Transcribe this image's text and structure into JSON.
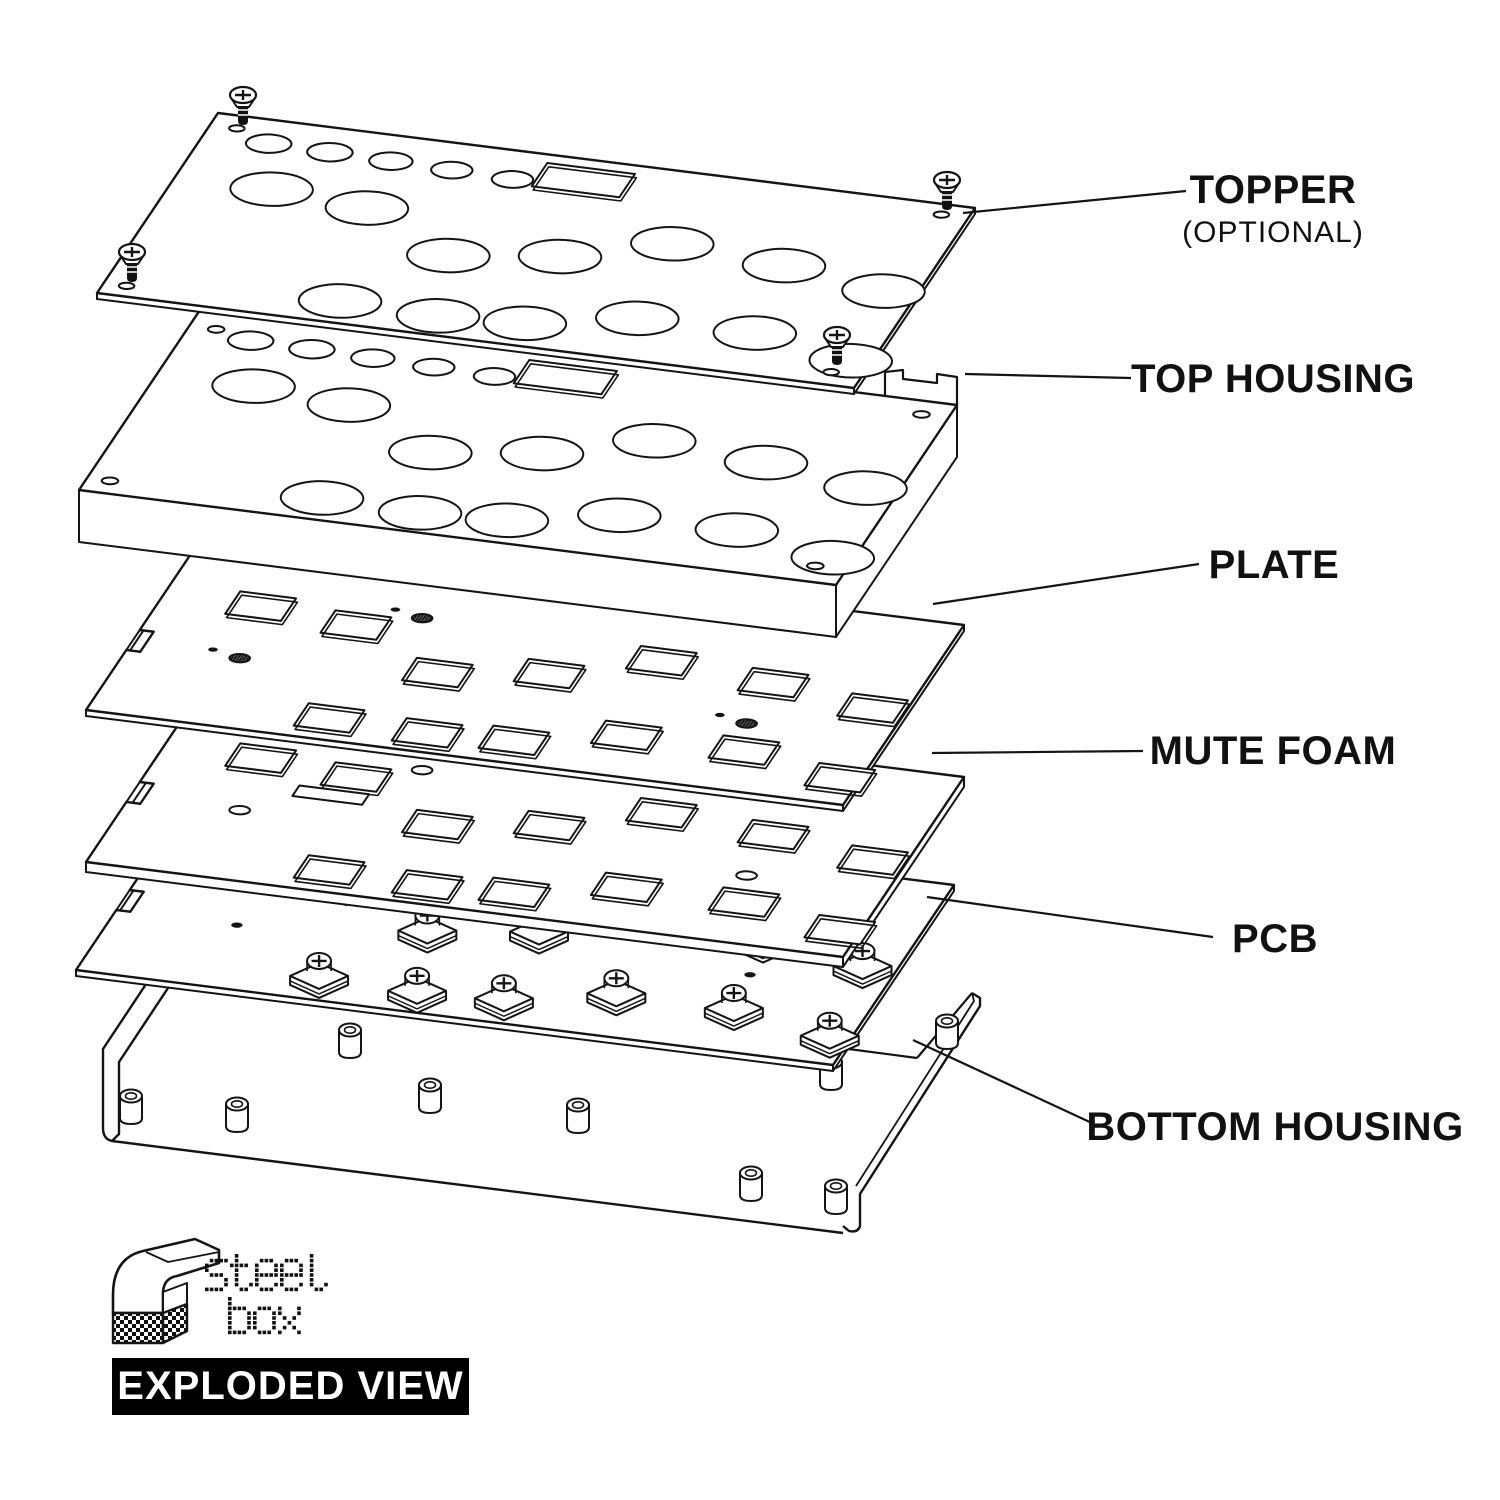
{
  "diagram": {
    "layers": [
      {
        "id": "topper",
        "label": "TOPPER",
        "note": "(OPTIONAL)"
      },
      {
        "id": "top-housing",
        "label": "TOP HOUSING"
      },
      {
        "id": "plate",
        "label": "PLATE"
      },
      {
        "id": "mute-foam",
        "label": "MUTE FOAM"
      },
      {
        "id": "pcb",
        "label": "PCB"
      },
      {
        "id": "bottom-housing",
        "label": "BOTTOM HOUSING"
      }
    ]
  },
  "logo": {
    "line1": "steel",
    "line2": "box"
  },
  "badge": {
    "text": "EXPLODED VIEW"
  },
  "colors": {
    "ink": "#141414",
    "background": "#ffffff",
    "badge_bg": "#000000",
    "badge_text": "#ffffff"
  }
}
